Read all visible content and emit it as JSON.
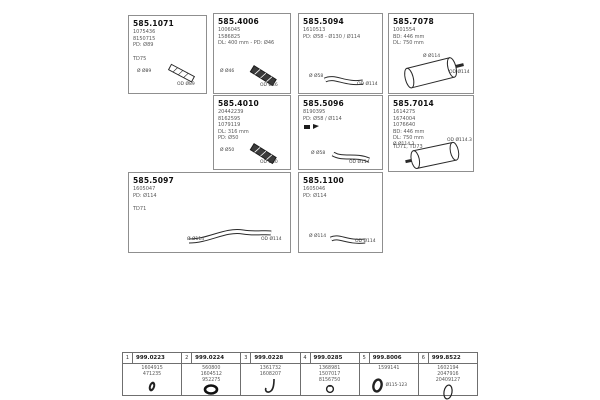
{
  "boxes": [
    {
      "title": "585.1071",
      "codes": [
        "1075436",
        "8150715",
        "PD: Ø89"
      ],
      "note": "TD75",
      "labels": {
        "left": "Ø Ø89",
        "right": "OD Ø89"
      }
    },
    {
      "title": "585.4006",
      "codes": [
        "1006045",
        "1586825",
        "DL: 400 mm - PD: Ø46"
      ],
      "labels": {
        "left": "Ø Ø46",
        "right": "OD Ø46"
      }
    },
    {
      "title": "585.5094",
      "codes": [
        "1610513",
        "PD: Ø58 - Ø130 / Ø114"
      ],
      "labels": {
        "left": "Ø Ø58",
        "right": "OD Ø114"
      }
    },
    {
      "title": "585.7078",
      "codes": [
        "1001554",
        "BD: 446 mm",
        "DL: 750 mm"
      ],
      "labels": {
        "left": "Ø Ø114",
        "right": "OD Ø114"
      }
    },
    {
      "title": "585.4010",
      "codes": [
        "20442239",
        "8162595",
        "1079119",
        "DL: 316 mm",
        "PD: Ø50"
      ],
      "labels": {
        "left": "Ø Ø50",
        "right": "OD Ø50"
      }
    },
    {
      "title": "585.5096",
      "codes": [
        "8190395",
        "PD: Ø58 / Ø114"
      ],
      "labels": {
        "left": "Ø Ø58",
        "right": "OD Ø114"
      }
    },
    {
      "title": "585.7014",
      "codes": [
        "1614275",
        "1674004",
        "1076640",
        "BD: 446 mm",
        "DL: 750 mm"
      ],
      "note": "TD71, TD73",
      "labels": {
        "left": "Ø Ø114.3",
        "right": "OD Ø114.3"
      }
    },
    {
      "title": "585.5097",
      "codes": [
        "1605047",
        "PD: Ø114"
      ],
      "note": "TD71",
      "labels": {
        "left": "Ø Ø114",
        "right": "OD Ø114"
      }
    },
    {
      "title": "585.1100",
      "codes": [
        "1605046",
        "PD: Ø114"
      ],
      "labels": {
        "left": "Ø Ø114",
        "right": "OD Ø114"
      }
    }
  ],
  "accessories": {
    "items": [
      {
        "num": "1",
        "title": "999.0223",
        "codes": [
          "1604915",
          "471235"
        ]
      },
      {
        "num": "2",
        "title": "999.0224",
        "codes": [
          "560800",
          "1604512",
          "952275"
        ]
      },
      {
        "num": "3",
        "title": "999.0228",
        "codes": [
          "1361732",
          "1608207"
        ]
      },
      {
        "num": "4",
        "title": "999.0285",
        "codes": [
          "1368981",
          "1507017",
          "8156750"
        ]
      },
      {
        "num": "5",
        "title": "999.8006",
        "codes": [
          "1599141"
        ],
        "icon_label": "Ø115-123"
      },
      {
        "num": "6",
        "title": "999.8522",
        "codes": [
          "1602194",
          "2047916",
          "20409127"
        ]
      }
    ]
  }
}
